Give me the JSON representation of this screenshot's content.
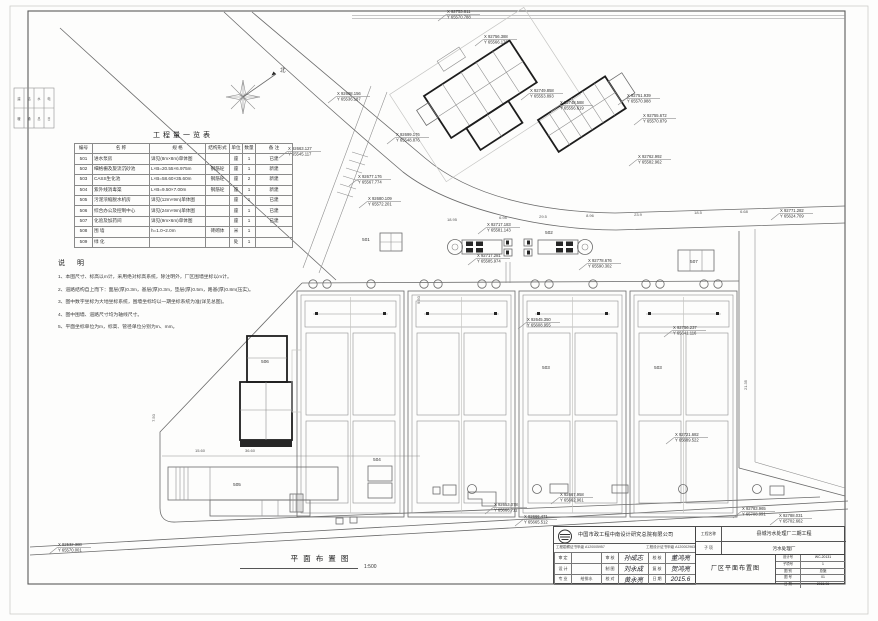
{
  "sheet": {
    "caption": {
      "title": "平面布置图",
      "scale": "1:500"
    },
    "edge_cells": [
      "建",
      "结",
      "水",
      "电",
      "暖",
      "通",
      "总",
      "日"
    ]
  },
  "compass": {
    "north_label": "北"
  },
  "quantity_table": {
    "title": "工程量一览表",
    "headers": [
      "编号",
      "名  称",
      "规  格",
      "结构形式",
      "单位",
      "数量",
      "备  注"
    ],
    "rows": [
      [
        "501",
        "进水泵房",
        "详见(8m×8m)单体图",
        "",
        "座",
        "1",
        "已建"
      ],
      [
        "502",
        "细格栅及旋流沉砂池",
        "L×B=20.55×6.975m",
        "钢筋砼",
        "座",
        "1",
        "新建"
      ],
      [
        "503",
        "CASS生化池",
        "L×B=58.60×35.60m",
        "钢筋砼",
        "座",
        "2",
        "新建"
      ],
      [
        "504",
        "紫外线消毒渠",
        "L×B=9.50×7.00m",
        "钢筋砼",
        "座",
        "1",
        "新建"
      ],
      [
        "505",
        "污泥浓缩脱水机房",
        "详见(12m×9m)单体图",
        "",
        "座",
        "1",
        "已建"
      ],
      [
        "506",
        "综合办公及控制中心",
        "详见(24m×9m)单体图",
        "",
        "座",
        "1",
        "已建"
      ],
      [
        "507",
        "化验及加药间",
        "详见(9m×6m)单体图",
        "",
        "座",
        "1",
        "已建"
      ],
      [
        "508",
        "围  墙",
        "h=1.0~2.0m",
        "砖砌体",
        "米",
        "1",
        ""
      ],
      [
        "509",
        "绿  化",
        "",
        "",
        "处",
        "1",
        ""
      ]
    ]
  },
  "notes": {
    "title": "说  明",
    "items": [
      "1、本图尺寸、标高以m计，采用绝对标高系统，除注明外，厂区围墙坐标以m计。",
      "2、道路结构自上而下：面层(厚)0.3m，基层(厚)0.3m，垫层(厚)0.5m，路基(厚)0.8m(压实)。",
      "3、图中数字坐标为大地坐标系统，围墙坐标均以一期坐标系统为准(详见总图)。",
      "4、图中围墙、道路尺寸均为轴线尺寸。",
      "5、平面坐标单位为m，标高、管径单位分别为m、mm。"
    ]
  },
  "coordinates": [
    {
      "x": "X 92753.611",
      "y": "Y 65570.788"
    },
    {
      "x": "X 92756.388",
      "y": "Y 65566.176"
    },
    {
      "x": "X 92749.858",
      "y": "Y 65553.893"
    },
    {
      "x": "X 92748.588",
      "y": "Y 65556.619"
    },
    {
      "x": "X 92751.939",
      "y": "Y 65570.988"
    },
    {
      "x": "X 92755.672",
      "y": "Y 65570.879"
    },
    {
      "x": "X 92762.992",
      "y": "Y 65582.962"
    },
    {
      "x": "X 92771.282",
      "y": "Y 65624.709"
    },
    {
      "x": "X 92698.156",
      "y": "Y 65536.187"
    },
    {
      "x": "X 92699.176",
      "y": "Y 65548.876"
    },
    {
      "x": "X 92663.127",
      "y": "Y 65545.117"
    },
    {
      "x": "X 92677.176",
      "y": "Y 65567.774"
    },
    {
      "x": "X 92680.109",
      "y": "Y 65572.201"
    },
    {
      "x": "X 92717.183",
      "y": "Y 65581.143"
    },
    {
      "x": "X 92717.281",
      "y": "Y 65585.974"
    },
    {
      "x": "X 92778.676",
      "y": "Y 65590.302"
    },
    {
      "x": "X 92645.350",
      "y": "Y 65608.955"
    },
    {
      "x": "X 92756.237",
      "y": "Y 65641.116"
    },
    {
      "x": "X 92721.682",
      "y": "Y 65689.522"
    },
    {
      "x": "X 92653.078",
      "y": "Y 65666.711"
    },
    {
      "x": "X 92666.471",
      "y": "Y 65665.512"
    },
    {
      "x": "X 92667.958",
      "y": "Y 65662.961"
    },
    {
      "x": "X 92685.539",
      "y": "Y 65639.921"
    },
    {
      "x": "X 92783.965",
      "y": "Y 65708.991"
    },
    {
      "x": "X 92788.031",
      "y": "Y 65702.662"
    },
    {
      "x": "X 92532.388",
      "y": "Y 65570.001"
    }
  ],
  "dimensions": [
    "18.95",
    "6.98",
    "29.5",
    "8.96",
    "23.9",
    "18.5",
    "6.68",
    "36.60",
    "15.60",
    "7.50",
    "21.35",
    "9.50"
  ],
  "structure_labels": [
    "501",
    "502",
    "503",
    "503",
    "504",
    "505",
    "506",
    "507"
  ],
  "titleblock": {
    "company": "中国市政工程中南设计研究总院有限公司",
    "cert1": "工程勘察证书甲级 A120005957",
    "cert2": "工程设计证书甲级 A120002963",
    "project_label": "工程名称",
    "project": "县城污水处理厂二期工程",
    "subitem_label": "子  项",
    "subitem": "污水处理厂",
    "drawing_name": "厂区平面布置图",
    "signatures": [
      [
        "审 定",
        "",
        "审 核",
        "孙成志",
        "校 核",
        "董鸿亮"
      ],
      [
        "设 计",
        "",
        "制 图",
        "刘永成",
        "复 核",
        "贺鸿亮"
      ],
      [
        "专 业",
        "给排水",
        "校 对",
        "黄永亮",
        "日 期",
        "2015.6"
      ]
    ],
    "fields": [
      {
        "label": "设计号",
        "value": "WC-20131"
      },
      {
        "label": "子项号",
        "value": "1"
      },
      {
        "label": "图 别",
        "value": "总施"
      },
      {
        "label": "图 号",
        "value": "01"
      },
      {
        "label": "日 期",
        "value": "2015.06"
      }
    ]
  }
}
